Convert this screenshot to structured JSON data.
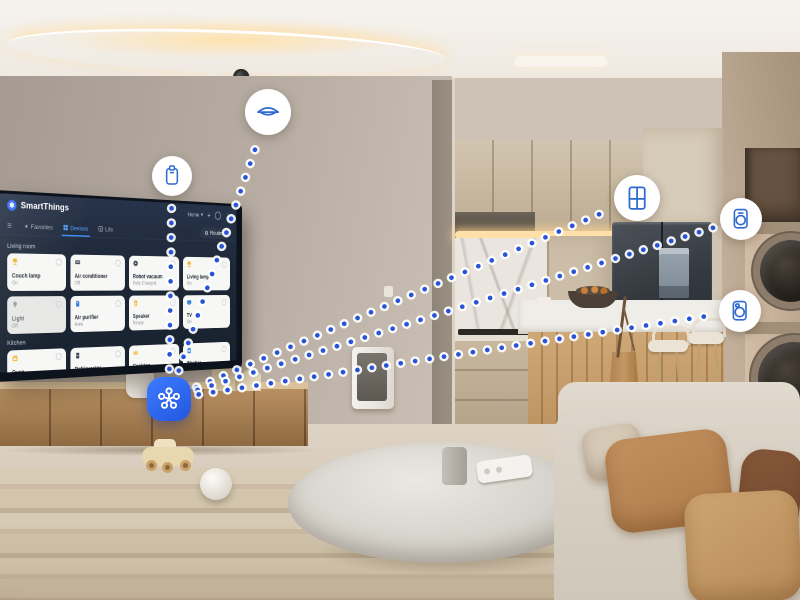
{
  "tv_dashboard": {
    "brand": "SmartThings",
    "logo_glyph": "✱",
    "top_bar": {
      "home_label": "Home",
      "caret": "▾",
      "plus": "+",
      "kebab": "⋮"
    },
    "tabs": [
      {
        "label": "Favorites",
        "icon": "star",
        "active": false
      },
      {
        "label": "Devices",
        "icon": "devices",
        "active": true
      },
      {
        "label": "Life",
        "icon": "life",
        "active": false
      }
    ],
    "routines_label": "Routines",
    "menu_glyph": "≡",
    "sections": [
      {
        "title": "Living room",
        "tiles": [
          {
            "name": "Couch lamp",
            "status": "On",
            "icon": "lamp",
            "icon_color": "#f0b429",
            "dimmed": false
          },
          {
            "name": "Air conditioner",
            "status": "Off",
            "icon": "ac",
            "icon_color": "#3d4654",
            "dimmed": false
          },
          {
            "name": "Robot vacuum",
            "status": "Fully Charged",
            "icon": "vacuum",
            "icon_color": "#3d4654",
            "dimmed": false
          },
          {
            "name": "Living lamp",
            "status": "On",
            "icon": "lamp",
            "icon_color": "#f0b429",
            "dimmed": false
          },
          {
            "name": "Light",
            "status": "Off",
            "icon": "bulb",
            "icon_color": "#9aa3ad",
            "dimmed": true
          },
          {
            "name": "Air purifier",
            "status": "Auto",
            "icon": "purifier",
            "icon_color": "#2f7de1",
            "dimmed": false
          },
          {
            "name": "Speaker",
            "status": "Ready",
            "icon": "speaker",
            "icon_color": "#f0b429",
            "dimmed": false
          },
          {
            "name": "TV",
            "status": "On",
            "icon": "tv",
            "icon_color": "#2f7de1",
            "dimmed": false
          }
        ]
      },
      {
        "title": "Kitchen",
        "tiles": [
          {
            "name": "Oven",
            "status": "",
            "icon": "oven",
            "icon_color": "#f0b429",
            "dimmed": false
          },
          {
            "name": "Refrigerator",
            "status": "",
            "icon": "fridge",
            "icon_color": "#3d4654",
            "dimmed": false
          },
          {
            "name": "Cooktop",
            "status": "",
            "icon": "cooktop",
            "icon_color": "#f0b429",
            "dimmed": false
          },
          {
            "name": "Washer",
            "status": "",
            "icon": "washer",
            "icon_color": "#2f7de1",
            "dimmed": false
          }
        ]
      }
    ]
  },
  "overlay": {
    "colors": {
      "dot_blue": "#2753d8",
      "dot_ring": "#ffffff",
      "icon_blue": "#2f6bd1",
      "hub_blue": "#2e6bf0"
    },
    "hub": {
      "id": "smartthings-hub",
      "x": 169,
      "y": 399
    },
    "devices": [
      {
        "id": "air-purifier",
        "icon": "purifier",
        "x": 172,
        "y": 176,
        "r": 20
      },
      {
        "id": "ceiling-light",
        "icon": "ceiling-light",
        "x": 268,
        "y": 112,
        "r": 23
      },
      {
        "id": "refrigerator",
        "icon": "fridge-grid",
        "x": 637,
        "y": 198,
        "r": 23
      },
      {
        "id": "washer",
        "icon": "washer",
        "x": 741,
        "y": 219,
        "r": 21
      },
      {
        "id": "dryer",
        "icon": "dryer",
        "x": 740,
        "y": 311,
        "r": 21
      }
    ],
    "connections": [
      {
        "from": "smartthings-hub",
        "to": "air-purifier"
      },
      {
        "from": "smartthings-hub",
        "to": "ceiling-light"
      },
      {
        "from": "smartthings-hub",
        "to": "refrigerator"
      },
      {
        "from": "smartthings-hub",
        "to": "washer"
      },
      {
        "from": "smartthings-hub",
        "to": "dryer"
      }
    ]
  }
}
